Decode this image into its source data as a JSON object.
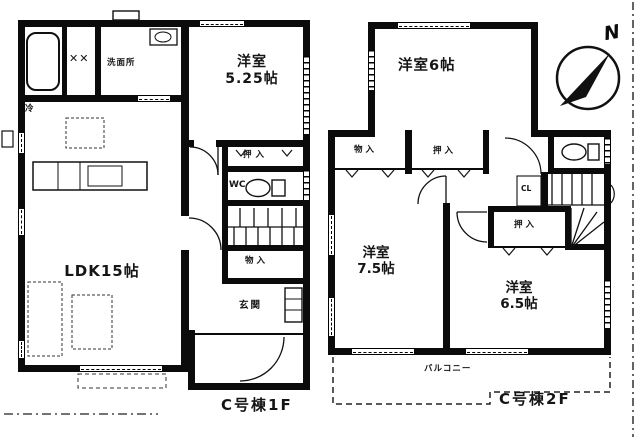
{
  "document": {
    "type": "floor-plan",
    "building": "C号棟"
  },
  "compass": {
    "north": "N"
  },
  "floor1": {
    "label": "C号棟1F",
    "ldk": "LDK15帖",
    "western_room_525": {
      "line1": "洋室",
      "line2": "5.25帖"
    },
    "washroom": "洗面所",
    "wc": "WC",
    "closet_oshiire": "押入",
    "closet_monoire": "物入",
    "entrance": "玄関",
    "fridge": "冷",
    "laundry_marks": "✕✕"
  },
  "floor2": {
    "label": "C号棟2F",
    "western_room_6": "洋室6帖",
    "western_room_75": {
      "line1": "洋室",
      "line2": "7.5帖"
    },
    "western_room_65": {
      "line1": "洋室",
      "line2": "6.5帖"
    },
    "closet_monoire": "物入",
    "closet_oshiire_top": "押入",
    "closet_oshiire_65": "押入",
    "closet_cl": "CL",
    "balcony": "バルコニー"
  }
}
